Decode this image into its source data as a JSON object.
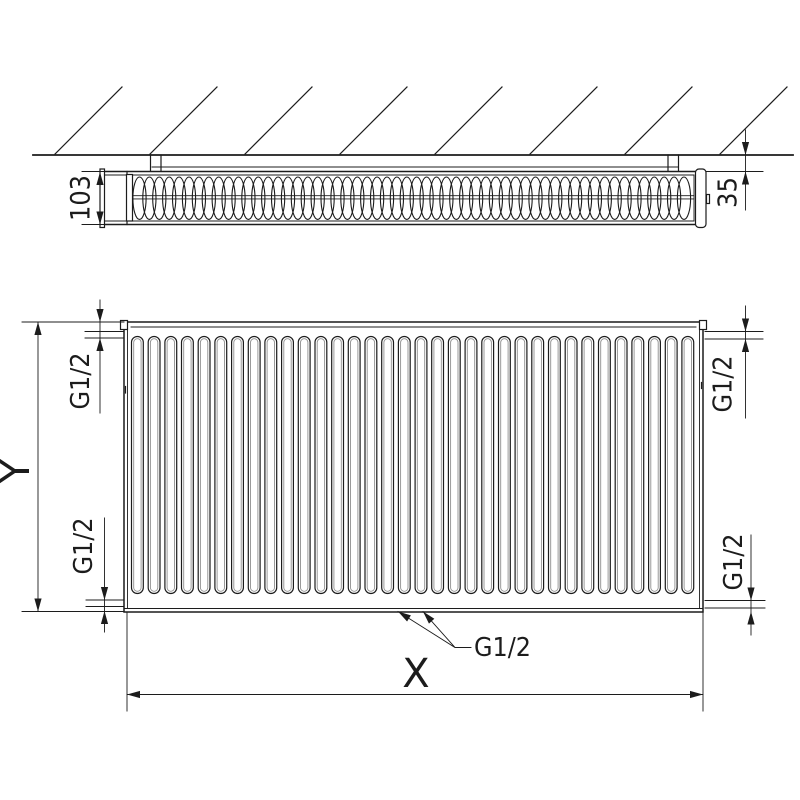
{
  "title": "Panel radiator technical dimension drawing (top view and front view)",
  "colors": {
    "line": "#1c1c1c",
    "secondary_line": "#8f8f8f",
    "background": "#ffffff"
  },
  "labels": {
    "depth": "103",
    "wall_distance": "35",
    "connection": "G1/2",
    "width": "X",
    "height": "Y"
  },
  "views": {
    "top_view": {
      "hatch_count": 8,
      "fin_count": 56,
      "bracket_count": 2
    },
    "front_view": {
      "channel_count": 34,
      "corner_connection_count": 4,
      "bottom_connection_count": 2
    }
  }
}
